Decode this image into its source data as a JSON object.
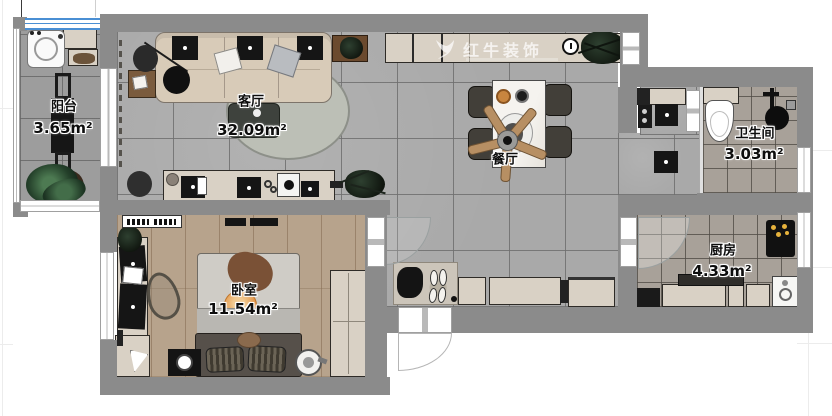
{
  "plan": {
    "watermark": {
      "brand": "红牛装饰"
    },
    "rooms": {
      "balcony": {
        "name": "阳台",
        "area": "3.65m²"
      },
      "living": {
        "name": "客厅",
        "area": "32.09m²"
      },
      "dining": {
        "name": "餐厅"
      },
      "bathroom": {
        "name": "卫生间",
        "area": "3.03m²"
      },
      "kitchen": {
        "name": "厨房",
        "area": "4.33m²"
      },
      "bedroom": {
        "name": "卧室",
        "area": "11.54m²"
      }
    },
    "colors": {
      "wall": "#8b8b8b",
      "tile_floor": "#a9a9a9",
      "wet_floor": "#a8a199",
      "wood_floor": "#b7a38c",
      "cabinet": "#d9d1c5",
      "window_accent": "#4a8fd4",
      "label_text": "#0d0d0d"
    }
  }
}
